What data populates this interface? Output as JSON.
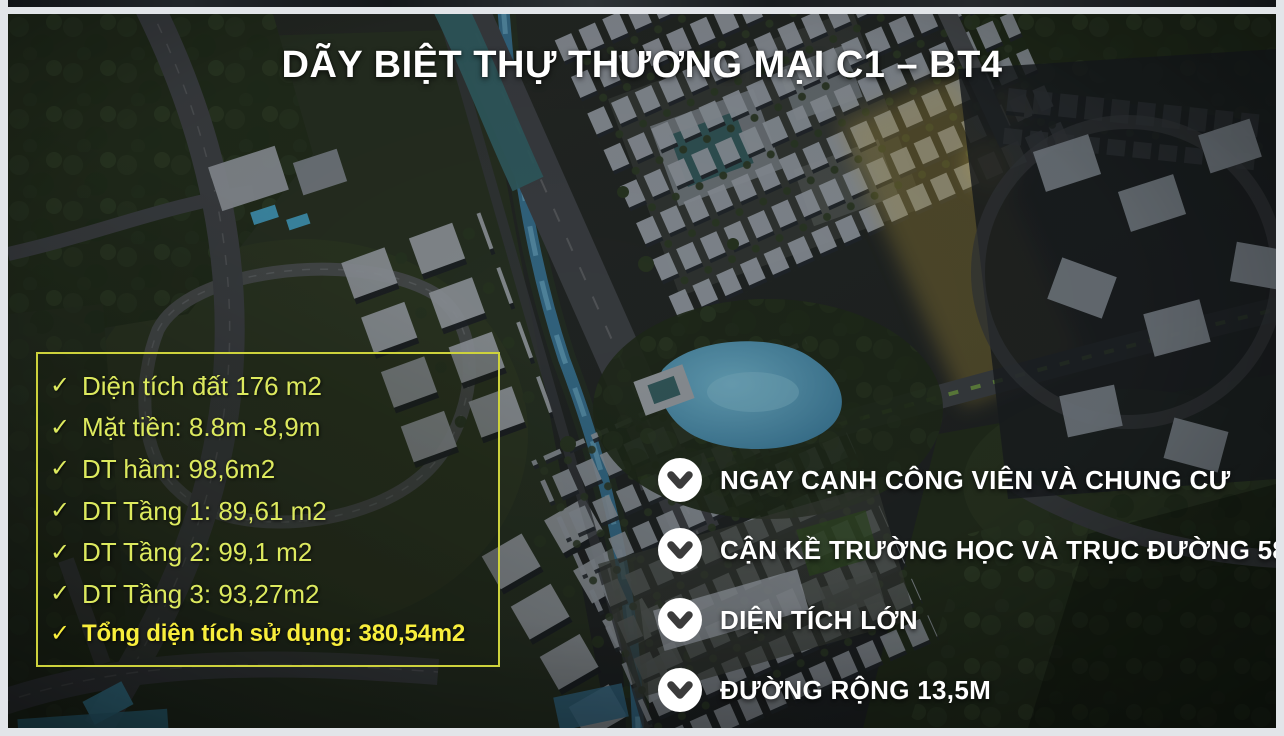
{
  "slide": {
    "title": "DÃY BIỆT THỰ THƯƠNG MẠI C1 – BT4",
    "specs_panel": {
      "check_icon": "✓",
      "items": [
        {
          "label": "Diện tích đất 176 m2"
        },
        {
          "label": "Mặt tiền: 8.8m -8,9m"
        },
        {
          "label": "DT hầm: 98,6m2"
        },
        {
          "label": "DT Tầng 1: 89,61 m2"
        },
        {
          "label": "DT Tầng 2: 99,1 m2"
        },
        {
          "label": "DT Tầng 3: 93,27m2"
        },
        {
          "label": "Tổng diện tích sử dụng: 380,54m2"
        }
      ]
    },
    "features": {
      "items": [
        "NGAY CẠNH CÔNG VIÊN VÀ CHUNG CƯ",
        "CẬN KỀ TRƯỜNG HỌC VÀ TRỤC ĐƯỜNG 58M",
        "DIỆN TÍCH LỚN",
        "ĐƯỜNG RỘNG 13,5M"
      ]
    },
    "colors": {
      "panel_border": "#cdd23c",
      "panel_text": "#dce95e",
      "panel_highlight_text": "#f8ee3c",
      "title_text": "#ffffff",
      "feature_text": "#ffffff",
      "check_circle_bg": "#ffffff",
      "check_circle_glyph": "#3b3b3b"
    },
    "icons": {
      "spec_bullet": "check-icon",
      "feature_bullet": "check-circle-icon"
    }
  }
}
